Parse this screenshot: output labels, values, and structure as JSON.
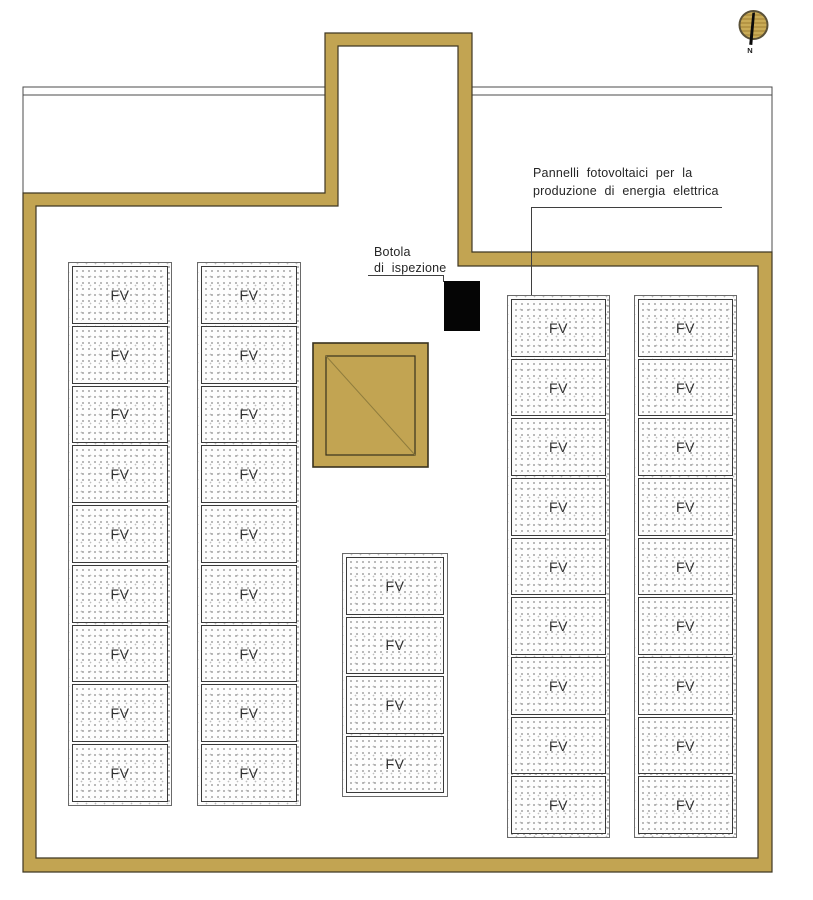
{
  "drawing": {
    "type": "roof-plan",
    "panel_label": "FV",
    "panels_total": 40,
    "annotations": {
      "pv": {
        "line1": "Pannelli  fotovoltaici  per  la",
        "line2": "produzione  di  energia  elettrica"
      },
      "hatch": {
        "line1": "Botola",
        "line2": "di  ispezione"
      }
    },
    "north": {
      "label": "N"
    },
    "panel_columns": [
      {
        "x": 68,
        "y": 262,
        "w": 104,
        "h": 544,
        "count": 9
      },
      {
        "x": 197,
        "y": 262,
        "w": 104,
        "h": 544,
        "count": 9
      },
      {
        "x": 342,
        "y": 553,
        "w": 106,
        "h": 244,
        "count": 4
      },
      {
        "x": 507,
        "y": 295,
        "w": 103,
        "h": 543,
        "count": 9
      },
      {
        "x": 634,
        "y": 295,
        "w": 103,
        "h": 543,
        "count": 9
      }
    ],
    "colors": {
      "wall": "#c2a452",
      "wall_outline": "#3f3723",
      "thin_line": "#4b4b4b",
      "leader_line": "#3f3f3f",
      "hatch_fill": "#050505",
      "skylight_diagonal": "#8f7c3d"
    }
  }
}
